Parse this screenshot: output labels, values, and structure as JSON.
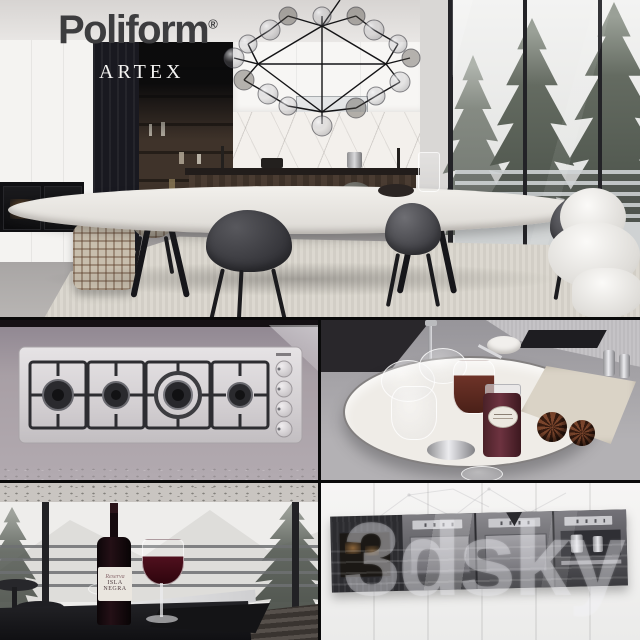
{
  "branding": {
    "logo": "Poliform",
    "registered": "®",
    "collection": "ARTEX"
  },
  "stills": {
    "wine_label_script": "Reserva",
    "wine_label_name": "ISLA NEGRA",
    "watermark": "3dsky"
  },
  "palette": {
    "logo_gray": "#3d3d3f",
    "panel_black": "#191920",
    "marble_white": "#f3f0ec",
    "wood_dark": "#40332a",
    "steel": "#d6d2d4",
    "counter_mauve": "#a89fa5",
    "snow_white": "#eeedeb",
    "wine_red": "#4a0e1b",
    "tartan_beige": "#c8bead",
    "fur_white": "#f2f1ee"
  }
}
